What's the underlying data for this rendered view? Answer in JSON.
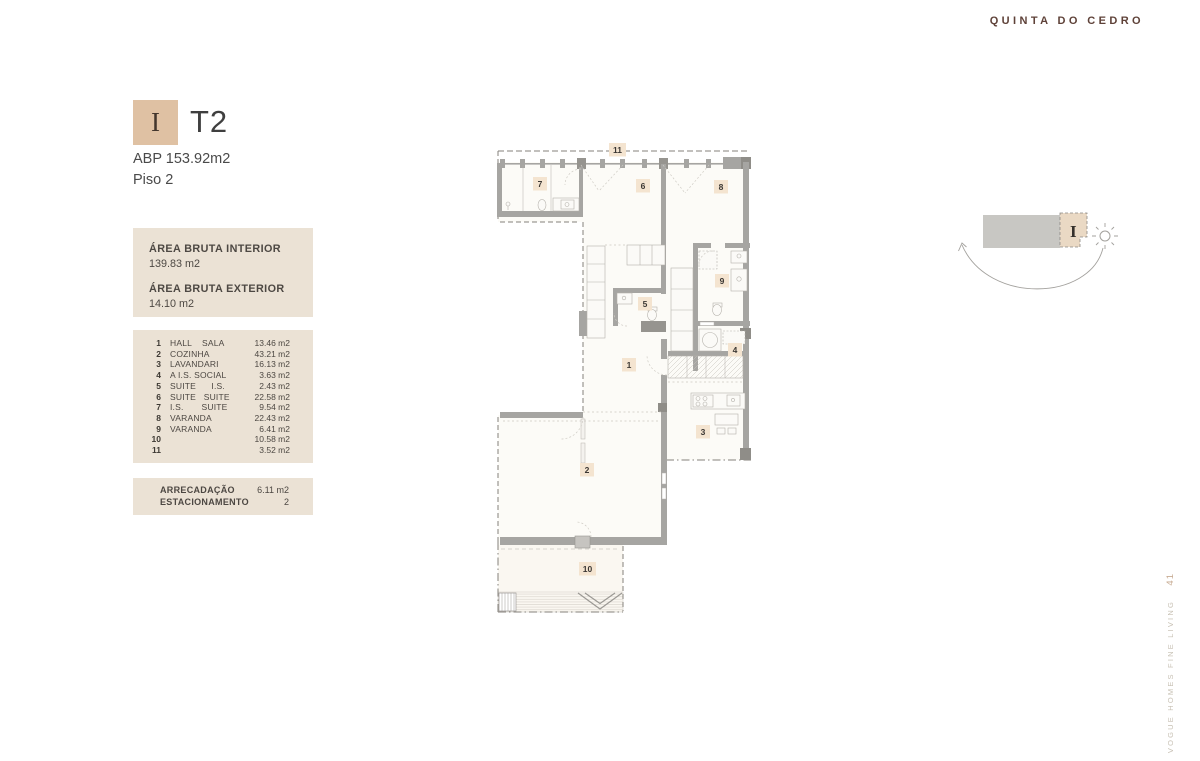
{
  "brand": {
    "name": "QUINTA DO CEDRO",
    "color": "#5e4138"
  },
  "unit": {
    "letter": "I",
    "type": "T2",
    "abp": "ABP 153.92m2",
    "floor": "Piso 2"
  },
  "areas": {
    "interior_label": "ÁREA BRUTA INTERIOR",
    "interior_value": "139.83 m2",
    "exterior_label": "ÁREA BRUTA EXTERIOR",
    "exterior_value": "14.10 m2"
  },
  "rooms": [
    {
      "num": "1",
      "label": "HALL    SALA",
      "area": "13.46 m2"
    },
    {
      "num": "2",
      "label": "COZINHA",
      "area": "43.21 m2"
    },
    {
      "num": "3",
      "label": "LAVANDARI",
      "area": "16.13 m2"
    },
    {
      "num": "4",
      "label": "A I.S. SOCIAL",
      "area": "3.63 m2"
    },
    {
      "num": "5",
      "label": "SUITE      I.S.",
      "area": "2.43 m2"
    },
    {
      "num": "6",
      "label": "SUITE   SUITE",
      "area": "22.58 m2"
    },
    {
      "num": "7",
      "label": "I.S.       SUITE",
      "area": "9.54 m2"
    },
    {
      "num": "8",
      "label": "VARANDA",
      "area": "22.43 m2"
    },
    {
      "num": "9",
      "label": "VARANDA",
      "area": "6.41 m2"
    },
    {
      "num": "10",
      "label": "",
      "area": "10.58 m2"
    },
    {
      "num": "11",
      "label": "",
      "area": "3.52 m2"
    }
  ],
  "extras": [
    {
      "label": "ARRECADAÇÃO",
      "value": "6.11 m2"
    },
    {
      "label": "ESTACIONAMENTO",
      "value": "2"
    }
  ],
  "floorplan": {
    "badges": [
      {
        "n": "1",
        "x": 127,
        "y": 215,
        "w": 14
      },
      {
        "n": "2",
        "x": 85,
        "y": 320,
        "w": 14
      },
      {
        "n": "3",
        "x": 201,
        "y": 282,
        "w": 14
      },
      {
        "n": "4",
        "x": 233,
        "y": 200,
        "w": 14
      },
      {
        "n": "5",
        "x": 143,
        "y": 154,
        "w": 14
      },
      {
        "n": "6",
        "x": 141,
        "y": 36,
        "w": 14
      },
      {
        "n": "7",
        "x": 38,
        "y": 34,
        "w": 14
      },
      {
        "n": "8",
        "x": 219,
        "y": 37,
        "w": 14
      },
      {
        "n": "9",
        "x": 220,
        "y": 131,
        "w": 14
      },
      {
        "n": "10",
        "x": 84,
        "y": 419,
        "w": 17
      },
      {
        "n": "11",
        "x": 114,
        "y": 0,
        "w": 17
      }
    ]
  },
  "locator": {
    "label": "I"
  },
  "footer": {
    "page": "41",
    "tagline": "VOGUE HOMES FINE LIVING"
  }
}
